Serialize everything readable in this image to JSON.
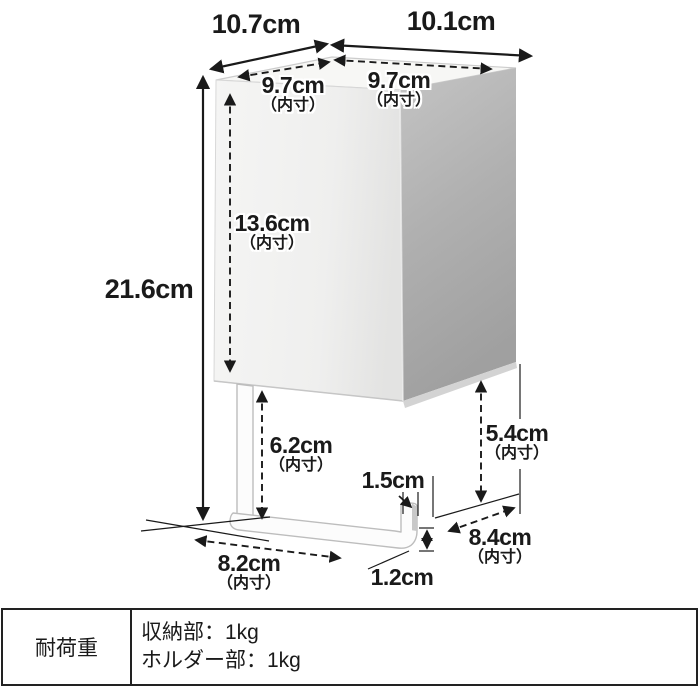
{
  "page": {
    "background": "#ffffff"
  },
  "diagram": {
    "title": "product-dimensions-diagram",
    "labels": {
      "outer_width": {
        "value": "10.7cm",
        "note": ""
      },
      "outer_depth": {
        "value": "10.1cm",
        "note": ""
      },
      "inner_width_top": {
        "value": "9.7cm",
        "note": "（内寸）"
      },
      "inner_depth_top": {
        "value": "9.7cm",
        "note": "（内寸）"
      },
      "outer_height": {
        "value": "21.6cm",
        "note": ""
      },
      "inner_height_box": {
        "value": "13.6cm",
        "note": "（内寸）"
      },
      "hook_inner_height_left": {
        "value": "6.2cm",
        "note": "（内寸）"
      },
      "hook_lip_width": {
        "value": "1.5cm",
        "note": ""
      },
      "hook_inner_height_right": {
        "value": "5.4cm",
        "note": "（内寸）"
      },
      "hook_inner_depth": {
        "value": "8.4cm",
        "note": "（内寸）"
      },
      "hook_inner_width": {
        "value": "8.2cm",
        "note": "（内寸）"
      },
      "hook_bar_thickness": {
        "value": "1.2cm",
        "note": ""
      }
    }
  },
  "spec_table": {
    "header": "耐荷重",
    "rows": [
      "収納部：1kg",
      "ホルダー部：1kg"
    ]
  },
  "colors": {
    "line": "#1a1a1a",
    "box_top": "#f7f7f5",
    "box_front": "#f1f1f0",
    "box_side": "#a9a9a9",
    "hook_fill": "#fcfcfc",
    "hook_outline": "#bdbdbd",
    "table_border": "#222222"
  }
}
